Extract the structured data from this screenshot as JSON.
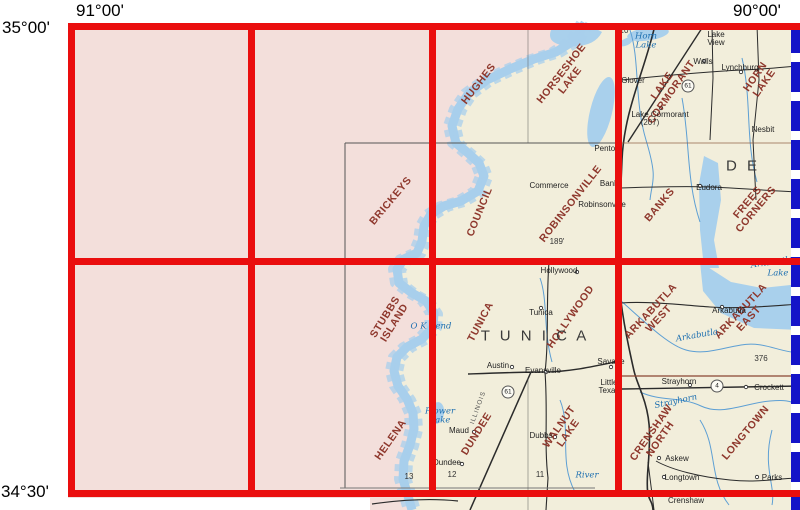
{
  "title": "Topographic quadrangle index map",
  "corner_labels": {
    "lon_left": "91°00'",
    "lon_right": "90°00'",
    "lat_top": "35°00'",
    "lat_bottom": "34°30'"
  },
  "colors": {
    "grid_red": "#ea0e0e",
    "selection_blue": "#1414c8",
    "quad_label_maroon": "#8e372c",
    "unmapped_pink": "#f3dfdb",
    "map_cream": "#f2eedb",
    "water_blue": "#a9d0ec",
    "water_text_blue": "#1d6fb0"
  },
  "labels": [
    {
      "cls": "quad",
      "text": "HUGHES",
      "x": 479,
      "y": 84,
      "rot": -52
    },
    {
      "cls": "quad",
      "text": "HORSESHOE\nLAKE",
      "x": 566,
      "y": 77,
      "rot": -52
    },
    {
      "cls": "quad",
      "text": "LAKE\nCORMORANT",
      "x": 667,
      "y": 89,
      "rot": -55
    },
    {
      "cls": "quad",
      "text": "HORN LAKE",
      "x": 760,
      "y": 80,
      "rot": -55
    },
    {
      "cls": "quad",
      "text": "BRICKEYS",
      "x": 391,
      "y": 201,
      "rot": -50
    },
    {
      "cls": "quad",
      "text": "COUNCIL",
      "x": 480,
      "y": 212,
      "rot": -68
    },
    {
      "cls": "quad",
      "text": "ROBINSONVILLE",
      "x": 571,
      "y": 204,
      "rot": -52
    },
    {
      "cls": "quad",
      "text": "BANKS",
      "x": 660,
      "y": 205,
      "rot": -50
    },
    {
      "cls": "quad",
      "text": "FREES\nCORNERS",
      "x": 752,
      "y": 206,
      "rot": -50
    },
    {
      "cls": "quad",
      "text": "STUBBS\nISLAND",
      "x": 390,
      "y": 320,
      "rot": -58
    },
    {
      "cls": "quad",
      "text": "TUNICA",
      "x": 481,
      "y": 322,
      "rot": -62
    },
    {
      "cls": "quad",
      "text": "HOLLYWOOD",
      "x": 571,
      "y": 317,
      "rot": -55
    },
    {
      "cls": "quad",
      "text": "ARKABUTLA\nWEST",
      "x": 655,
      "y": 315,
      "rot": -47
    },
    {
      "cls": "quad",
      "text": "ARKABUTLA\nEAST",
      "x": 745,
      "y": 315,
      "rot": -47
    },
    {
      "cls": "quad",
      "text": "HELENA",
      "x": 391,
      "y": 440,
      "rot": -55
    },
    {
      "cls": "quad",
      "text": "DUNDEE",
      "x": 477,
      "y": 434,
      "rot": -58
    },
    {
      "cls": "quad",
      "text": "WALNUT\nLAKE",
      "x": 564,
      "y": 430,
      "rot": -55
    },
    {
      "cls": "quad",
      "text": "CRENSHAW\nNORTH",
      "x": 656,
      "y": 436,
      "rot": -55
    },
    {
      "cls": "quad",
      "text": "LONGTOWN",
      "x": 746,
      "y": 433,
      "rot": -50
    },
    {
      "cls": "county",
      "text": "D E",
      "x": 743,
      "y": 166,
      "rot": 0
    },
    {
      "cls": "county",
      "text": "T U N I C A",
      "x": 535,
      "y": 336,
      "rot": 0
    },
    {
      "cls": "town",
      "text": "Lake\nView",
      "x": 716,
      "y": 39,
      "rot": 0
    },
    {
      "cls": "town",
      "text": "Walls",
      "x": 703,
      "y": 62,
      "rot": 0
    },
    {
      "cls": "town",
      "text": "Lynchburg",
      "x": 740,
      "y": 68,
      "rot": 0
    },
    {
      "cls": "town",
      "text": "Glover",
      "x": 633,
      "y": 81,
      "rot": 0
    },
    {
      "cls": "town",
      "text": "Lake Cormorant",
      "x": 660,
      "y": 115,
      "rot": 0
    },
    {
      "cls": "town",
      "text": "Nesbit",
      "x": 763,
      "y": 130,
      "rot": 0
    },
    {
      "cls": "town",
      "text": "Penton",
      "x": 607,
      "y": 149,
      "rot": 0
    },
    {
      "cls": "town",
      "text": "Commerce",
      "x": 549,
      "y": 186,
      "rot": 0
    },
    {
      "cls": "town",
      "text": "Banks",
      "x": 611,
      "y": 184,
      "rot": 0
    },
    {
      "cls": "town",
      "text": "Robinsonville",
      "x": 602,
      "y": 205,
      "rot": 0
    },
    {
      "cls": "town",
      "text": "Eudora",
      "x": 709,
      "y": 188,
      "rot": 0
    },
    {
      "cls": "town",
      "text": "Hollywood",
      "x": 559,
      "y": 271,
      "rot": 0
    },
    {
      "cls": "town",
      "text": "Tunica",
      "x": 541,
      "y": 313,
      "rot": 0
    },
    {
      "cls": "town",
      "text": "Austin",
      "x": 498,
      "y": 366,
      "rot": 0
    },
    {
      "cls": "town",
      "text": "Evansville",
      "x": 543,
      "y": 371,
      "rot": 0
    },
    {
      "cls": "town",
      "text": "Savage",
      "x": 611,
      "y": 362,
      "rot": 0
    },
    {
      "cls": "town",
      "text": "Little\nTexas",
      "x": 609,
      "y": 387,
      "rot": 0
    },
    {
      "cls": "town",
      "text": "Arkabutla",
      "x": 729,
      "y": 311,
      "rot": 0
    },
    {
      "cls": "town",
      "text": "Strayhorn",
      "x": 679,
      "y": 382,
      "rot": 0
    },
    {
      "cls": "town",
      "text": "Crockett",
      "x": 769,
      "y": 388,
      "rot": 0
    },
    {
      "cls": "town",
      "text": "Askew",
      "x": 677,
      "y": 459,
      "rot": 0
    },
    {
      "cls": "town",
      "text": "Longtown",
      "x": 682,
      "y": 478,
      "rot": 0
    },
    {
      "cls": "town",
      "text": "Parks",
      "x": 772,
      "y": 478,
      "rot": 0
    },
    {
      "cls": "town",
      "text": "Crenshaw",
      "x": 686,
      "y": 501,
      "rot": 0
    },
    {
      "cls": "town",
      "text": "Maud",
      "x": 459,
      "y": 431,
      "rot": 0
    },
    {
      "cls": "town",
      "text": "Dubbs",
      "x": 541,
      "y": 436,
      "rot": 0
    },
    {
      "cls": "town",
      "text": "Dundee",
      "x": 447,
      "y": 463,
      "rot": 0
    },
    {
      "cls": "water",
      "text": "Horn\nLake",
      "x": 646,
      "y": 41,
      "rot": 0
    },
    {
      "cls": "water",
      "text": "O K Bend",
      "x": 431,
      "y": 327,
      "rot": 0
    },
    {
      "cls": "water",
      "text": "Flower\nLake",
      "x": 440,
      "y": 416,
      "rot": 0
    },
    {
      "cls": "water",
      "text": "River",
      "x": 587,
      "y": 476,
      "rot": 0
    },
    {
      "cls": "water",
      "text": "Arkabutla",
      "x": 697,
      "y": 336,
      "rot": -10
    },
    {
      "cls": "water",
      "text": "Arkabutla",
      "x": 772,
      "y": 263,
      "rot": -8
    },
    {
      "cls": "water",
      "text": "Lake",
      "x": 778,
      "y": 274,
      "rot": 0
    },
    {
      "cls": "water",
      "text": "Strayhorn",
      "x": 676,
      "y": 402,
      "rot": -12
    },
    {
      "cls": "num",
      "text": "10",
      "x": 624,
      "y": 31,
      "rot": 0
    },
    {
      "cls": "num",
      "text": "9",
      "x": 684,
      "y": 28,
      "rot": 0
    },
    {
      "cls": "num",
      "text": "8",
      "x": 765,
      "y": 28,
      "rot": 0
    },
    {
      "cls": "num",
      "text": "(207)",
      "x": 650,
      "y": 123,
      "rot": 0
    },
    {
      "cls": "num",
      "text": "189'",
      "x": 557,
      "y": 242,
      "rot": 0
    },
    {
      "cls": "num",
      "text": "376",
      "x": 761,
      "y": 359,
      "rot": 0
    },
    {
      "cls": "num",
      "text": "12",
      "x": 452,
      "y": 475,
      "rot": 0
    },
    {
      "cls": "num",
      "text": "11",
      "x": 540,
      "y": 475,
      "rot": 0
    },
    {
      "cls": "num",
      "text": "13",
      "x": 409,
      "y": 477,
      "rot": 0
    },
    {
      "cls": "shield",
      "text": "61",
      "x": 688,
      "y": 86,
      "rot": 0
    },
    {
      "cls": "shield",
      "text": "61",
      "x": 508,
      "y": 392,
      "rot": 0
    },
    {
      "cls": "shield",
      "text": "4",
      "x": 717,
      "y": 386,
      "rot": 0
    },
    {
      "cls": "rr",
      "text": "ILLINOIS",
      "x": 479,
      "y": 408,
      "rot": -70
    }
  ]
}
